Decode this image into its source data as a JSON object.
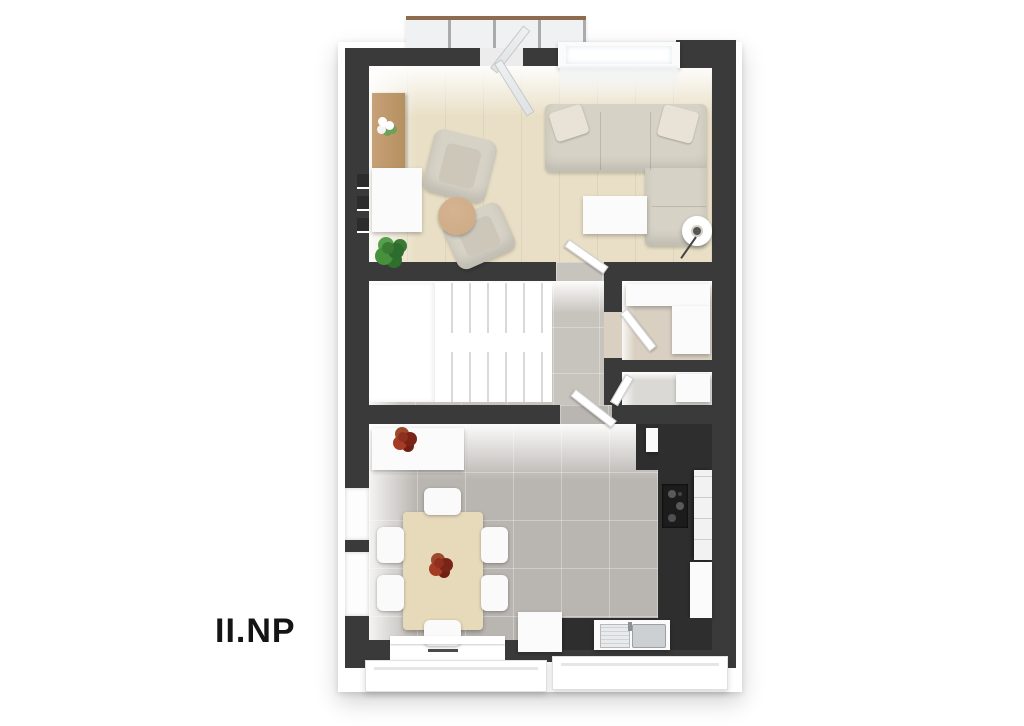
{
  "label": {
    "floor_label": "II.NP"
  },
  "palette": {
    "wall": "#3a3a3a",
    "floor_wood": "#e9dfc6",
    "floor_tile_hall": "#c7c3bd",
    "floor_tile_dining": "#b9b5b0",
    "floor_room_a": "#d9d0c2",
    "floor_room_b": "#dbd9d5",
    "sofa": "#d6d2c6",
    "pillow": "#e8e3d6",
    "wood_sideboard": "#c7a177",
    "wood_round_table": "#cdaa84",
    "wood_dining_table": "#e7dabb",
    "counter_dark": "#2e2e2e",
    "plant_green": "#3a7a33",
    "plant_red": "#8e2f1f",
    "railing_wood": "#8d6b4f",
    "label_color": "#141414"
  }
}
